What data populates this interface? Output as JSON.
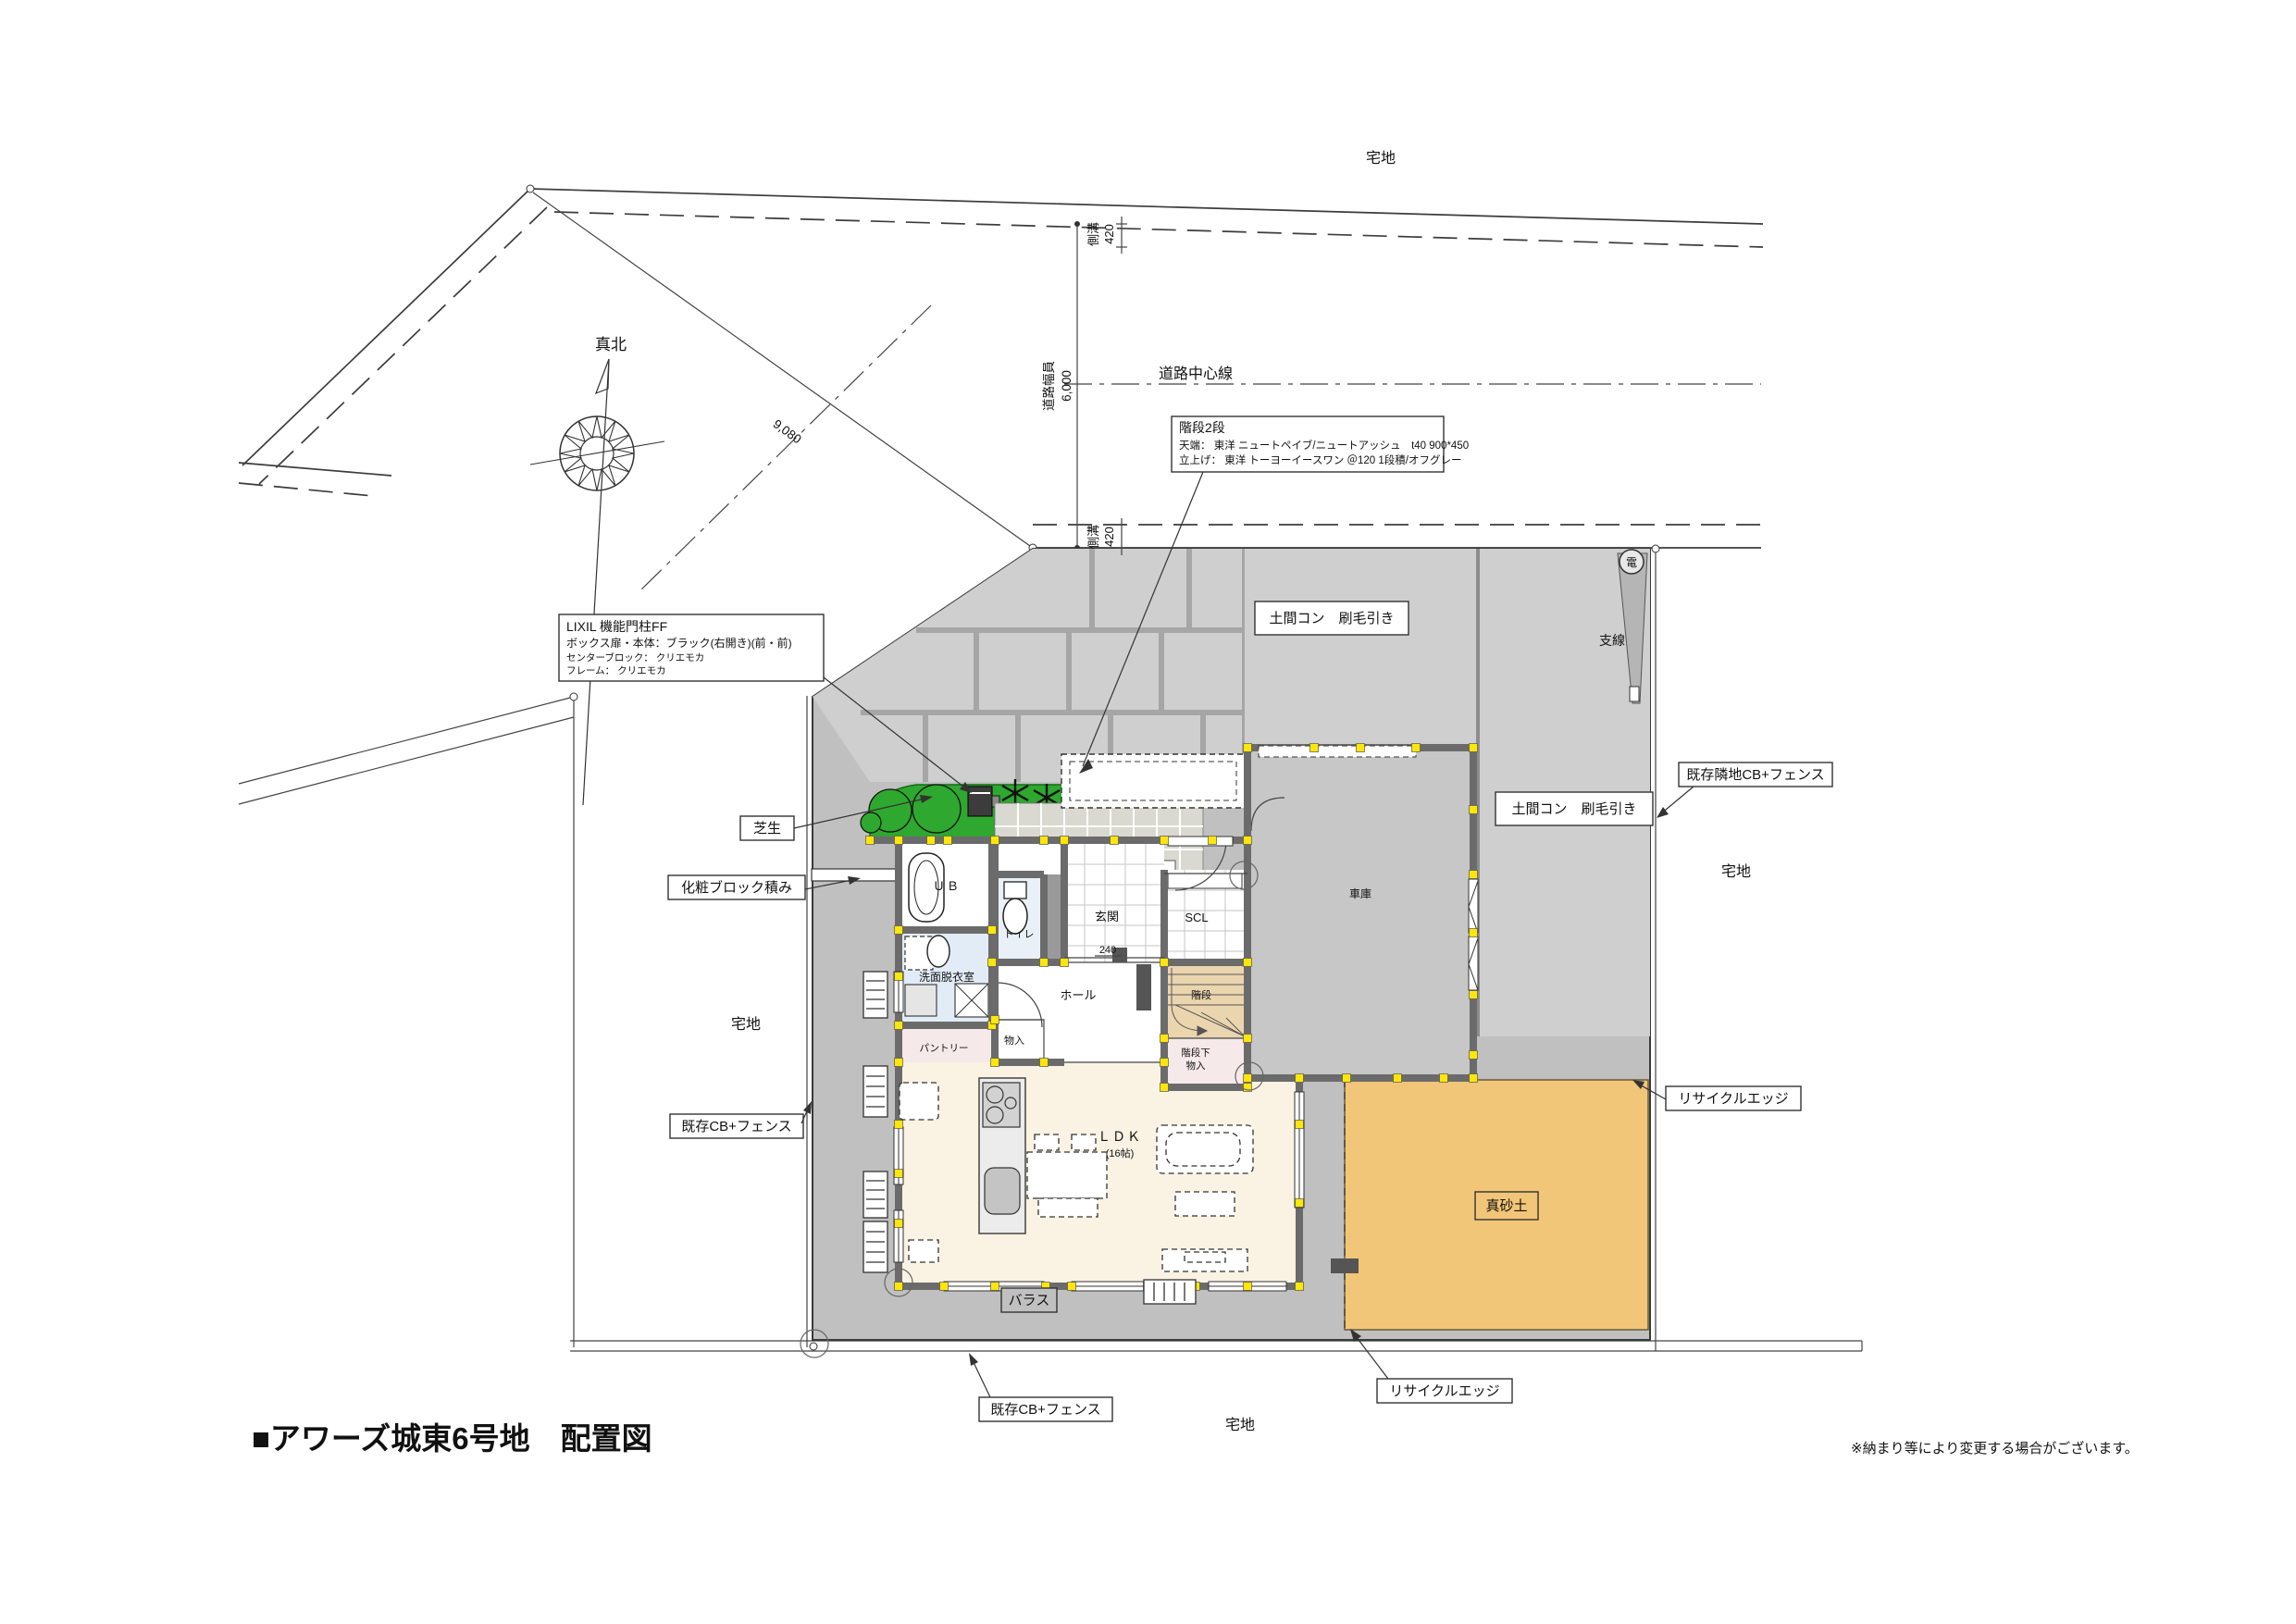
{
  "meta": {
    "title": "■アワーズ城東6号地　配置図",
    "note": "※納まり等により変更する場合がございます。"
  },
  "areas": {
    "takuchi": "宅地",
    "masado": "真砂土",
    "barasu": "バラス",
    "shibafu": "芝生",
    "shako": "車庫",
    "domacon": "土間コン　刷毛引き"
  },
  "boundary": {
    "roadCenterline": "道路中心線",
    "sokko": "側溝",
    "sokkoValue": "420",
    "roadWidth": "道路幅員",
    "roadWidthValue": "6,000",
    "frontage": "9,080",
    "trueNorth": "真北",
    "dim240": "240"
  },
  "annotations": {
    "stair": {
      "l1": "階段2段",
      "l2": "天端： 東洋 ニュートペイブ/ニュートアッシュ　t40 900*450",
      "l3": "立上げ： 東洋 トーヨーイースワン ＠120 1段積/オフグレー"
    },
    "gatepost": {
      "l1": "LIXIL 機能門柱FF",
      "l2": "ボックス扉・本体：ブラック(右開き)(前・前)",
      "l3": "センターブロック： クリエモカ",
      "l4": "フレーム： クリエモカ"
    },
    "keshoBlock": "化粧ブロック積み",
    "existingFence": "既存CB+フェンス",
    "existingNeighborFence": "既存隣地CB+フェンス",
    "recycleEdge": "リサイクルエッジ",
    "power": "電",
    "guyWire": "支線"
  },
  "rooms": {
    "ub": "ＵＢ",
    "toilet": "トイレ",
    "genkan": "玄関",
    "scl": "SCL",
    "hall": "ホール",
    "stairs": "階段",
    "underStair1": "階段下",
    "underStair2": "物入",
    "closet": "物入",
    "pantry": "パントリー",
    "washroom": "洗面脱衣室",
    "ldk": "ＬＤＫ",
    "ldkSize": "(16帖)"
  },
  "colors": {
    "lawn": "#2EA82E",
    "soil": "#F2C678",
    "marker": "#FFE60A",
    "concreteLight": "#CFCFCF",
    "siteGray": "#C0C0C0",
    "stairFloor": "#EBD5AF",
    "waterRoom": "#E2ECF7",
    "ldkFloor": "#FAF2E3",
    "wall": "#6B6B6B"
  }
}
